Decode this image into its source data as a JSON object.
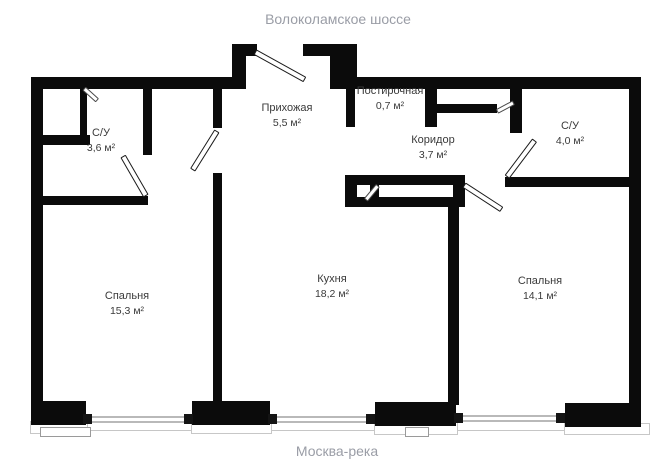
{
  "labels": {
    "top": "Волоколамское шоссе",
    "bottom": "Москва-река"
  },
  "rooms": [
    {
      "name": "С/У",
      "area": "3,6 м²"
    },
    {
      "name": "Прихожая",
      "area": "5,5 м²"
    },
    {
      "name": "Постирочная",
      "area": "0,7 м²"
    },
    {
      "name": "Коридор",
      "area": "3,7 м²"
    },
    {
      "name": "С/У",
      "area": "4,0 м²"
    },
    {
      "name": "Спальня",
      "area": "15,3 м²"
    },
    {
      "name": "Кухня",
      "area": "18,2 м²"
    },
    {
      "name": "Спальня",
      "area": "14,1 м²"
    }
  ],
  "colors": {
    "wall": "#0b0b0b",
    "room_label": "#3a3a3a",
    "street_label": "#9a9da6",
    "background": "#ffffff"
  }
}
